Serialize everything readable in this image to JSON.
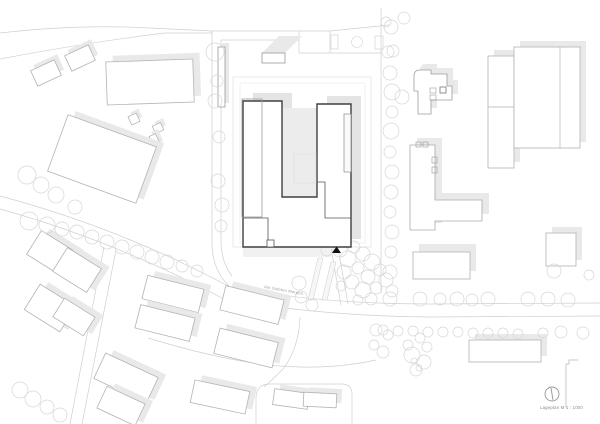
{
  "title": "Lageplan",
  "labels": {
    "street_name": "Am Siebten Morgen",
    "scale_caption": "Lageplan M 1 : 1000"
  },
  "icons": {
    "north_indicator": "north-arrow"
  },
  "colors": {
    "background": "#ffffff",
    "road_line": "#cfcfcf",
    "site_boundary": "#e0e0e0",
    "context_building_stroke": "#b3b3b3",
    "shadow_fill": "#e9e9e9",
    "highlight_building_stroke": "#3f3f3f",
    "courtyard_fill": "#ececec",
    "tree_stroke": "#d6d6d6",
    "entrance_marker": "#111111",
    "text_color": "#999999"
  }
}
